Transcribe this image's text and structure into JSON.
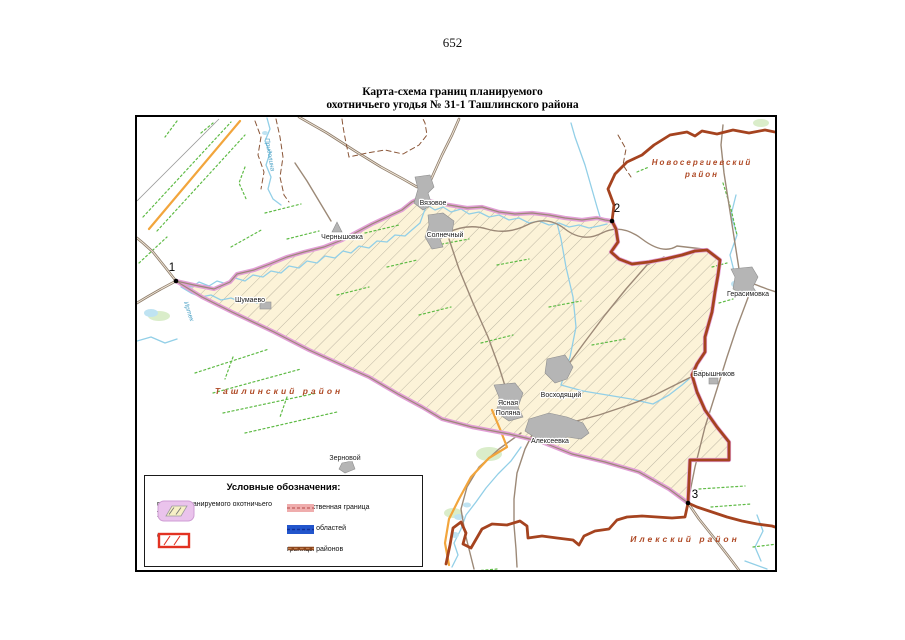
{
  "page": {
    "number": "652"
  },
  "title": {
    "line1": "Карта-схема границ планируемого",
    "line2": "охотничьего угодья № 31-1 Ташлинского района"
  },
  "map": {
    "points": [
      {
        "label": "1"
      },
      {
        "label": "2"
      },
      {
        "label": "3"
      }
    ],
    "settlements": [
      {
        "name": "Вязовое"
      },
      {
        "name": "Чернышовка"
      },
      {
        "name": "Солнечный"
      },
      {
        "name": "Шумаево"
      },
      {
        "name": "Герасимовка"
      },
      {
        "name": "Барышников"
      },
      {
        "name": "Ясная Поляна",
        "lines": [
          "Ясная",
          "Поляна"
        ]
      },
      {
        "name": "Восходящий"
      },
      {
        "name": "Алексеевка"
      },
      {
        "name": "Зерновой"
      }
    ],
    "districts": [
      {
        "line1": "Новосергиевский",
        "line2": "район"
      },
      {
        "line1": "Ташлинский район"
      },
      {
        "line1": "Илекский район"
      }
    ],
    "rivers": [
      {
        "name": "Придолина"
      },
      {
        "name": "Иртек"
      }
    ],
    "colors": {
      "hunting_boundary": "#e29fd6",
      "hunting_fill": "#fcf3d8",
      "hatch_line": "#b7b09d",
      "district_boundary": "#a5431f",
      "state_border_band": "#efadad",
      "region_border": "#2255cc",
      "river": "#92cfe7",
      "road": "#9c8977",
      "orange_road": "#f2a53c",
      "field_line": "#5fbb46",
      "district_label": "#af4a26"
    }
  },
  "legend": {
    "title": "Условные обозначения:",
    "items": [
      {
        "label": "граница планируемого охотничьего угодья"
      },
      {
        "label": "ООПТ"
      },
      {
        "label": "государственная граница"
      },
      {
        "label": "границы областей"
      },
      {
        "label": "границы районов"
      }
    ]
  }
}
